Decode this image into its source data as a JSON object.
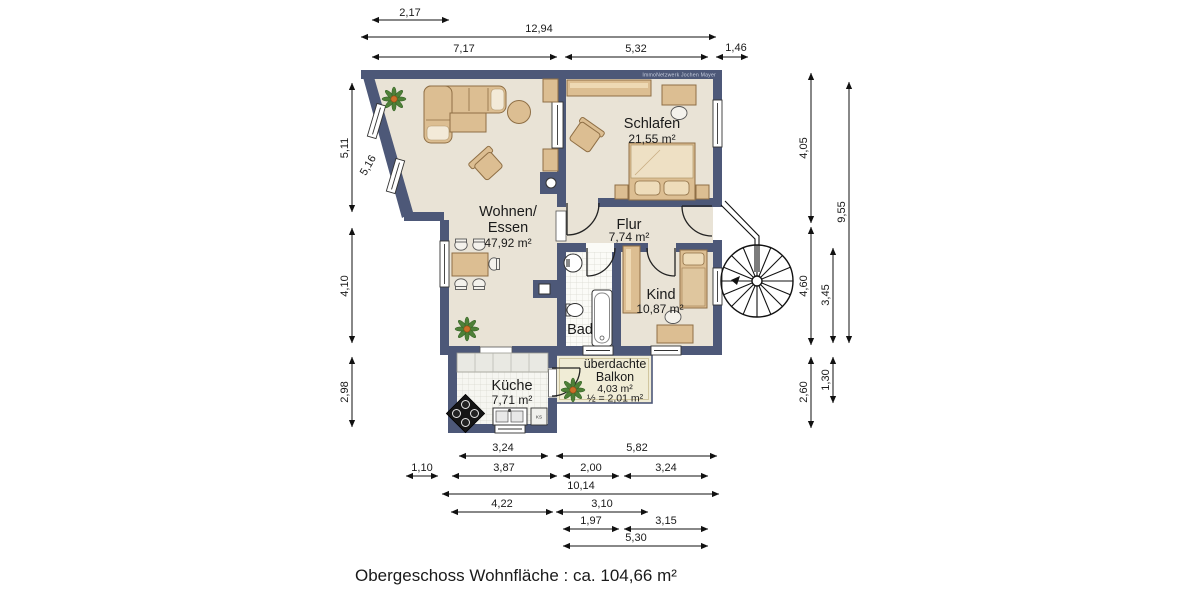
{
  "title": "Obergeschoss Wohnfläche : ca. 104,66 m²",
  "watermark": "ImmoNetzwerk Jochen Mayer",
  "colors": {
    "wall": "#4d5878",
    "floor": "#e9e3d6",
    "furniture": "#dcbe92",
    "balcony_floor": "#f0ecd6",
    "tile_floor": "#fbfbf7",
    "dimension_text": "#1a1a1a"
  },
  "rooms": {
    "wohnen": {
      "name1": "Wohnen/",
      "name2": "Essen",
      "area": "47,92 m²"
    },
    "schlafen": {
      "name": "Schlafen",
      "area": "21,55 m²"
    },
    "flur": {
      "name": "Flur",
      "area": "7,74 m²"
    },
    "kind": {
      "name": "Kind",
      "area": "10,87 m²"
    },
    "bad": {
      "name": "Bad"
    },
    "kueche": {
      "name": "Küche",
      "area": "7,71 m²",
      "appliance": "KS"
    },
    "balkon": {
      "name1": "überdachte",
      "name2": "Balkon",
      "area": "4,03 m²",
      "half_area": "½ = 2,01 m²"
    }
  },
  "dims": {
    "top": [
      "2,17",
      "12,94",
      "7,17",
      "5,32",
      "1,46"
    ],
    "left": [
      "5,11",
      "5,16",
      "4,10",
      "2,98"
    ],
    "right": [
      "4,05",
      "9,55",
      "4,60",
      "3,45",
      "2,60",
      "1,30"
    ],
    "bottom": [
      "3,24",
      "5,82",
      "1,10",
      "3,87",
      "2,00",
      "3,24",
      "10,14",
      "4,22",
      "3,10",
      "1,97",
      "3,15",
      "5,30"
    ]
  }
}
